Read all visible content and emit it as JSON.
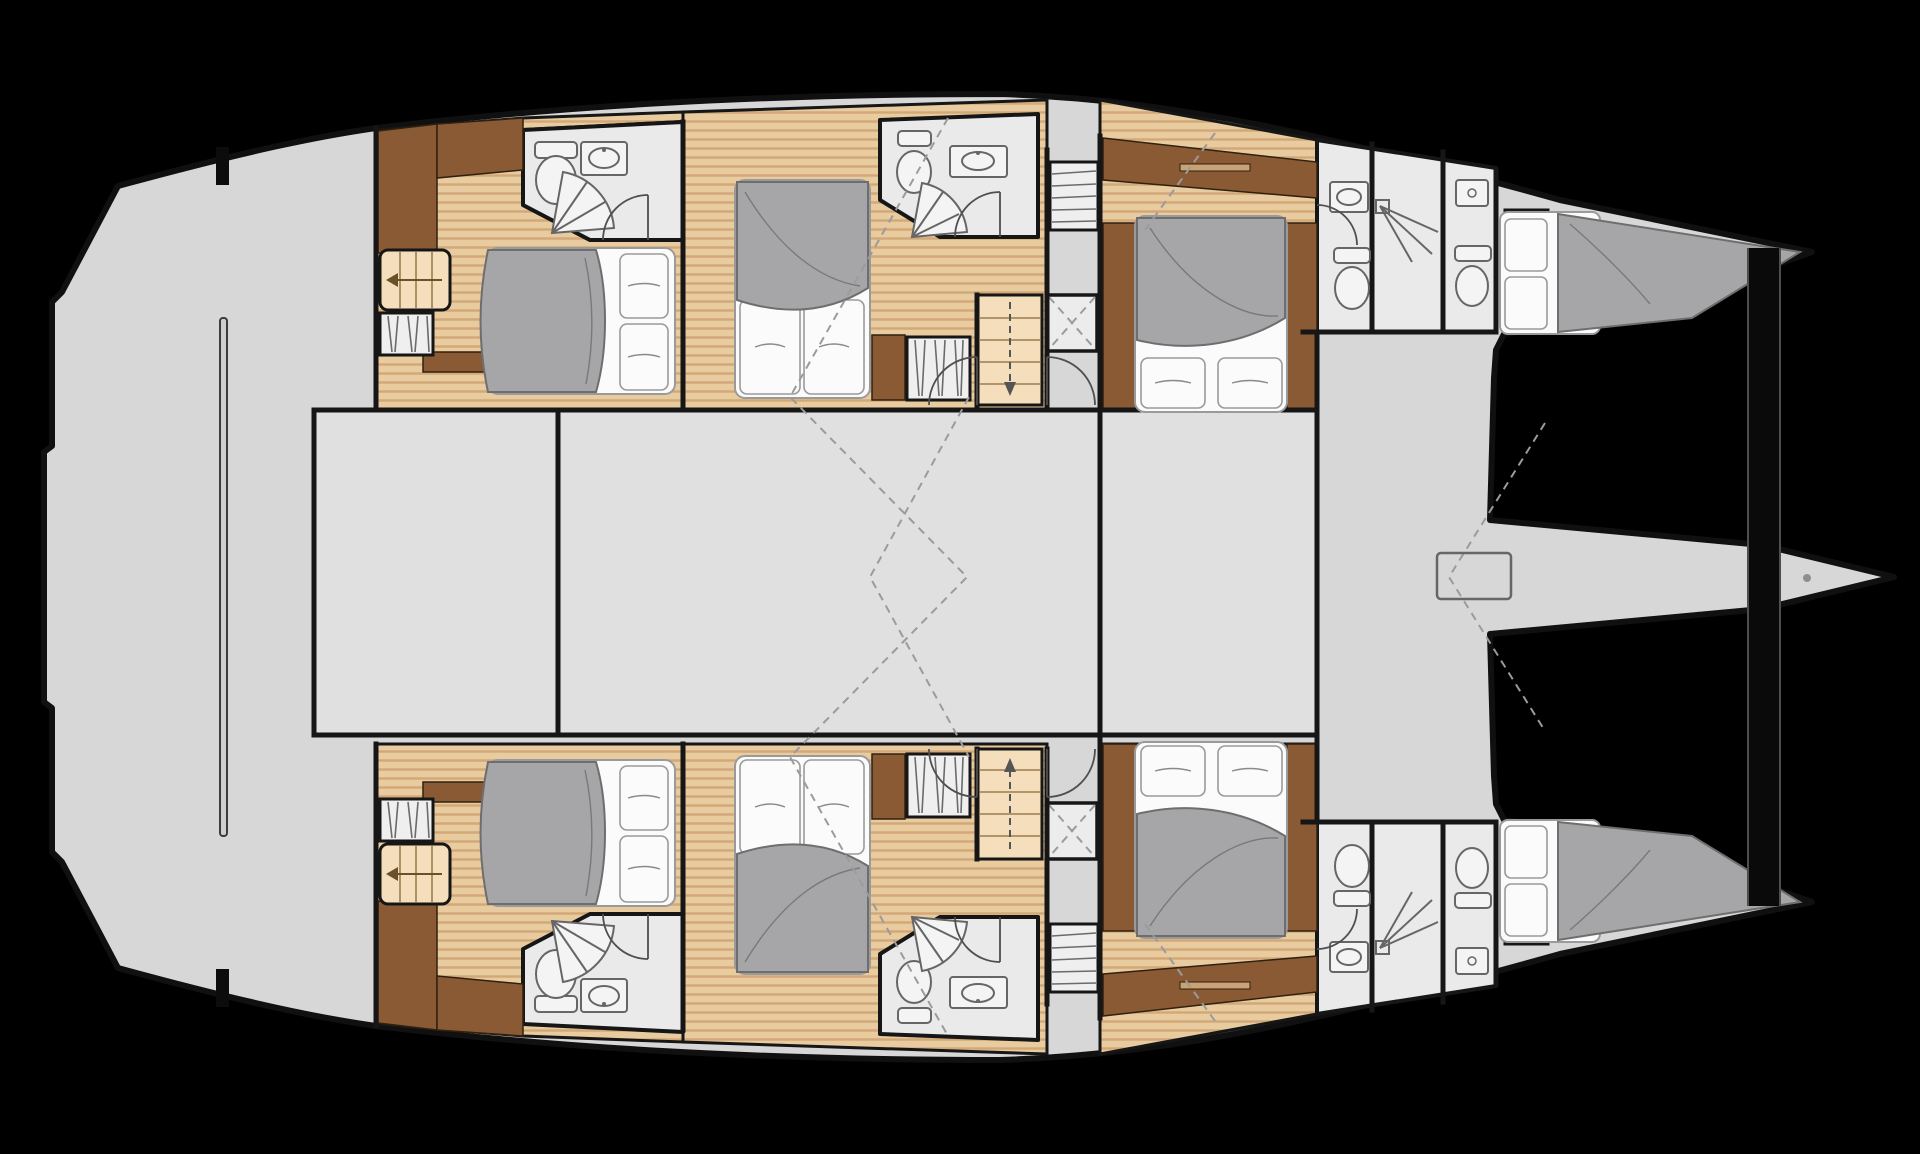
{
  "meta": {
    "title": "Catamaran yacht floor plan - lower deck cabin layout",
    "diagram_type": "boat-floor-plan",
    "orientation": "bow-right"
  },
  "colors": {
    "background": "#000000",
    "deck": "#d7d7d8",
    "room": "#e0e0e1",
    "bathroom_floor": "#eaeaeb",
    "wood_floor": "#e9cba0",
    "wood_stripe": "#d2a877",
    "stairs_wood": "#f4debb",
    "dark_wood": "#8a5a35",
    "bed_blanket": "#a6a6a8",
    "bed_linen": "#fbfbfb",
    "wall": "#161616",
    "dashed_guide": "#9b9b9b"
  },
  "inventory": {
    "cabins": [
      {
        "id": "cabin-port-aft",
        "bed": "double",
        "bed_heading": "east",
        "ensuite": true
      },
      {
        "id": "cabin-port-mid",
        "bed": "double",
        "bed_heading": "south",
        "ensuite": true
      },
      {
        "id": "cabin-port-forward",
        "bed": "double",
        "bed_heading": "south",
        "ensuite": false
      },
      {
        "id": "cabin-starboard-aft",
        "bed": "double",
        "bed_heading": "east",
        "ensuite": true
      },
      {
        "id": "cabin-starboard-mid",
        "bed": "double",
        "bed_heading": "north",
        "ensuite": true
      },
      {
        "id": "cabin-starboard-forward",
        "bed": "double",
        "bed_heading": "north",
        "ensuite": false
      }
    ],
    "bow_berths": [
      {
        "id": "port-bow-berth",
        "bed": "single"
      },
      {
        "id": "starboard-bow-berth",
        "bed": "single"
      }
    ],
    "counts": {
      "toilets": 8,
      "sinks": 8,
      "showers": 6,
      "staircases": 4,
      "wardrobes": 8,
      "deck_hatches": 1,
      "salon_areas": 3
    },
    "structure": [
      "aft-deck",
      "forward-crossbeam",
      "bowsprit-platform",
      "hull-port",
      "hull-starboard"
    ]
  }
}
